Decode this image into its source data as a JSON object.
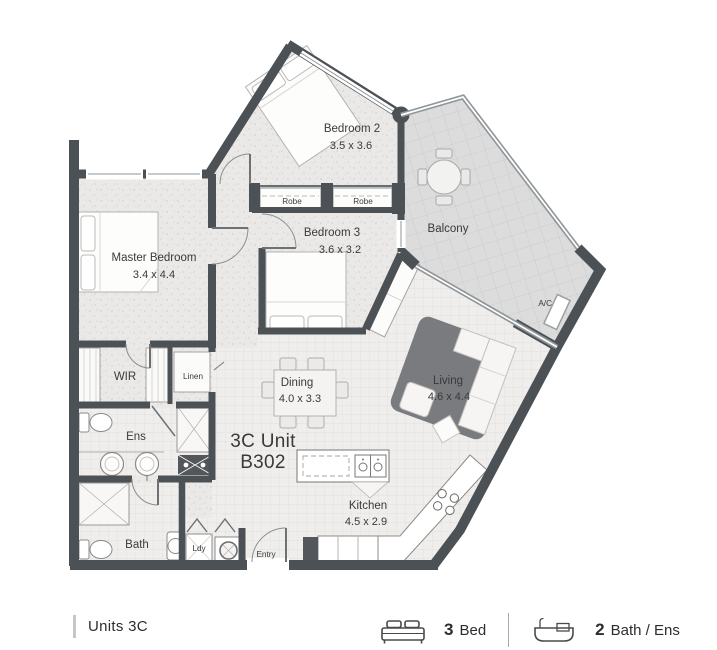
{
  "unit": {
    "line1": "3C Unit",
    "line2": "B302"
  },
  "rooms": {
    "bedroom2": {
      "name": "Bedroom 2",
      "dims": "3.5 x 3.6"
    },
    "bedroom3": {
      "name": "Bedroom 3",
      "dims": "3.6 x 3.2"
    },
    "master_bedroom": {
      "name": "Master Bedroom",
      "dims": "3.4 x 4.4"
    },
    "living": {
      "name": "Living",
      "dims": "4.6 x 4.4"
    },
    "dining": {
      "name": "Dining",
      "dims": "4.0 x 3.3"
    },
    "kitchen": {
      "name": "Kitchen",
      "dims": "4.5 x 2.9"
    },
    "balcony": {
      "name": "Balcony"
    },
    "wir": {
      "name": "WIR"
    },
    "linen": {
      "name": "Linen"
    },
    "ens": {
      "name": "Ens"
    },
    "bath": {
      "name": "Bath"
    },
    "ldy": {
      "name": "Ldy"
    },
    "entry": {
      "name": "Entry"
    },
    "robe1": {
      "name": "Robe"
    },
    "robe2": {
      "name": "Robe"
    },
    "ac": {
      "name": "A/C"
    }
  },
  "footer": {
    "units_label": "Units 3C",
    "bed_count": "3",
    "bed_label": "Bed",
    "bath_count": "2",
    "bath_label": "Bath / Ens"
  },
  "colors": {
    "wall": "#4c5155",
    "floor_speckle": "#eae9e7",
    "tile_floor": "#efeeec",
    "balcony_floor": "#dcdcdc",
    "rug": "#797b7e",
    "label_text": "#3a3a3a"
  }
}
